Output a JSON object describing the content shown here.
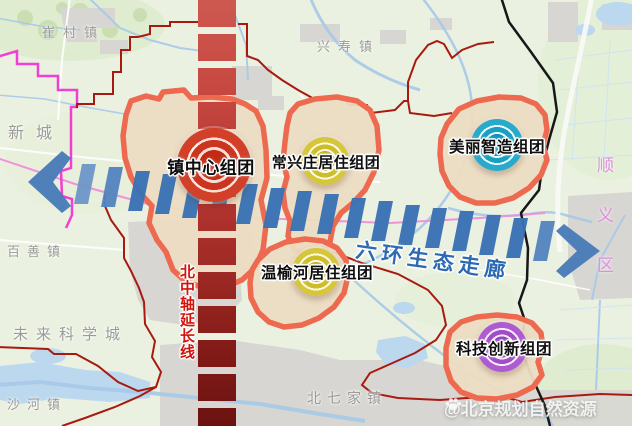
{
  "clusters": {
    "town_center": {
      "label": "镇中心组团",
      "color": "#d2402a"
    },
    "changxingzhuang": {
      "label": "常兴庄居住组团",
      "color": "#d6c63a"
    },
    "meili_zhizao": {
      "label": "美丽智造组团",
      "color": "#27aacb"
    },
    "wenyuhe": {
      "label": "温榆河居住组团",
      "color": "#d6c63a"
    },
    "keji_chuangxin": {
      "label": "科技创新组团",
      "color": "#ae5bd2"
    }
  },
  "corridors": {
    "north_axis": {
      "label": "北中轴延长线",
      "color": "#b53631",
      "orientation": "vertical"
    },
    "eco_corridor": {
      "label": "六环生态走廊",
      "color": "#3a72b4",
      "orientation": "horizontal"
    }
  },
  "places": {
    "cuicunzhen": "崔村镇",
    "xingshouzhen": "兴寿镇",
    "xincheng": "新城",
    "baishanzhen": "百善镇",
    "weilai_kexuecheng": "未来科学城",
    "shahezhen": "沙河镇",
    "beiqijiazhen": "北七家镇",
    "shunyiqu": "顺义区"
  },
  "watermark": {
    "label": "@北京规划自然资源"
  },
  "base_colors": {
    "land": "#ebf1e0",
    "urban": "#d7d6d2",
    "water": "#bcd8ee",
    "cluster_fill": "#ecdcc2",
    "cluster_outline": "#ed6a50",
    "district_boundary_pink": "#f13fd3",
    "town_boundary_red": "#a81a10",
    "district_boundary_black": "#171717"
  }
}
